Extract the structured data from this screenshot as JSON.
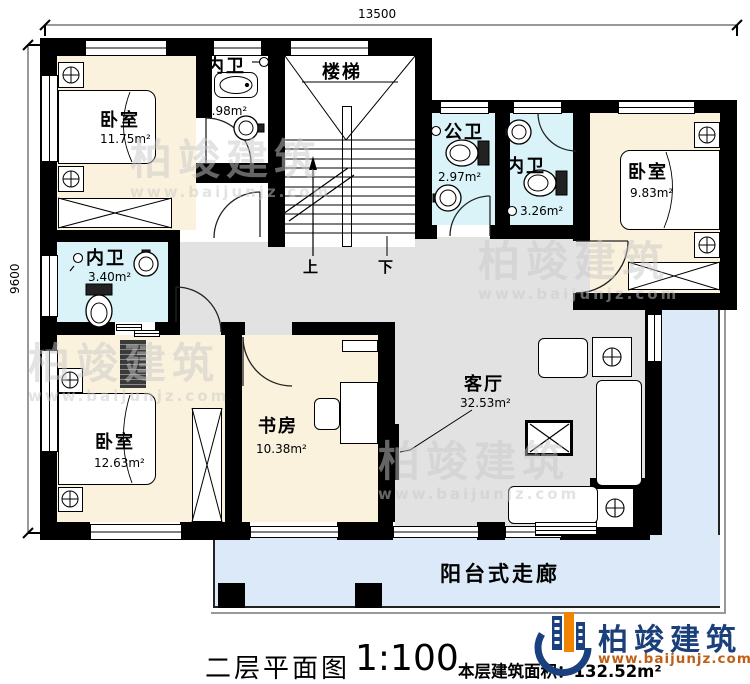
{
  "dimensions": {
    "top": "13500",
    "left": "9600"
  },
  "rooms": {
    "bedroom1": {
      "label": "卧室",
      "area": "11.75m²"
    },
    "bath1": {
      "label": "内卫",
      "area": "2.98m²"
    },
    "stairs": {
      "label": "楼梯",
      "up": "上",
      "down": "下"
    },
    "public_bath": {
      "label": "公卫",
      "area": "2.97m²"
    },
    "bath2": {
      "label": "内卫",
      "area": "3.26m²"
    },
    "bedroom2": {
      "label": "卧室",
      "area": "9.83m²"
    },
    "bath3": {
      "label": "内卫",
      "area": "3.40m²"
    },
    "bedroom3": {
      "label": "卧室",
      "area": "12.63m²"
    },
    "study": {
      "label": "书房",
      "area": "10.38m²"
    },
    "living": {
      "label": "客厅",
      "area": "32.53m²"
    },
    "balcony": {
      "label": "阳台式走廊"
    }
  },
  "titleblock": {
    "plan_title": "二层平面图",
    "scale": "1:100",
    "area_note": "本层建筑面积：132.52m²"
  },
  "logo": {
    "name": "柏竣建筑",
    "website": "www.baijunjz.com"
  },
  "watermark": {
    "name": "柏竣建筑",
    "website": "www.baijunjz.com"
  },
  "colors": {
    "wall": "#000000",
    "bedroom_floor": "#fbf2dd",
    "bath_floor": "#d9f3f8",
    "hall_floor": "#e2e2e2",
    "balcony_floor": "#dbe9f8",
    "logo_blue": "#1b3f7a",
    "logo_orange": "#f08300"
  }
}
